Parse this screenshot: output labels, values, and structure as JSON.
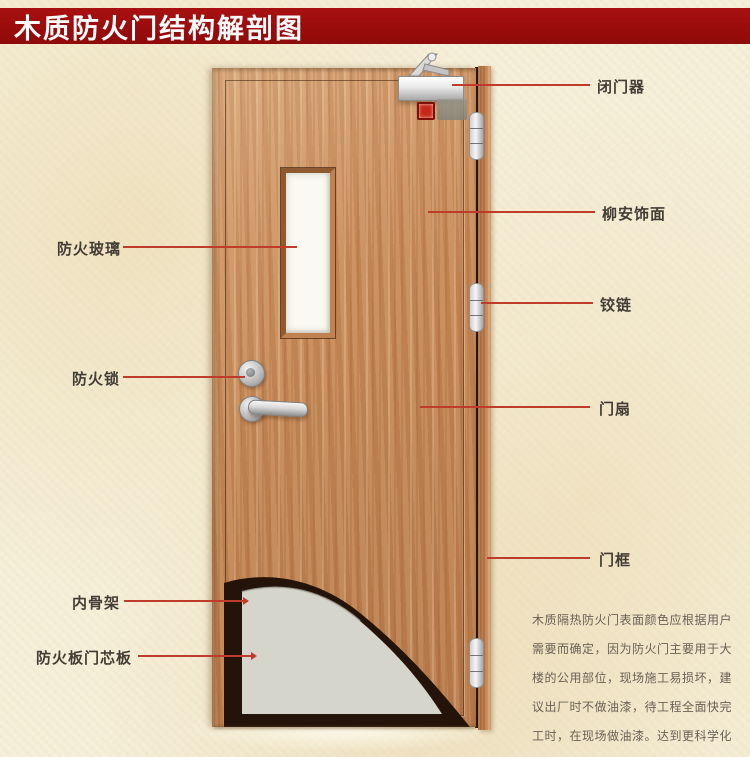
{
  "title": "木质防火门结构解剖图",
  "annotations": {
    "left": [
      {
        "id": "fire-glass",
        "text": "防火玻璃"
      },
      {
        "id": "fire-lock",
        "text": "防火锁"
      },
      {
        "id": "inner-skeleton",
        "text": "内骨架"
      },
      {
        "id": "core-board",
        "text": "防火板门芯板"
      }
    ],
    "right": [
      {
        "id": "door-closer",
        "text": "闭门器"
      },
      {
        "id": "lauan-veneer",
        "text": "柳安饰面"
      },
      {
        "id": "hinge",
        "text": "铰链"
      },
      {
        "id": "door-leaf",
        "text": "门扇"
      },
      {
        "id": "door-frame",
        "text": "门框"
      }
    ]
  },
  "description": {
    "lines": [
      "木质隔热防火门表面颜色应根据用户",
      "需要而确定，因为防火门主要用于大",
      "楼的公用部位，现场施工易损坏，建",
      "议出厂时不做油漆，待工程全面快完",
      "工时，在现场做油漆。达到更科学化",
      "更人性化的服务。"
    ]
  },
  "colors": {
    "banner_red": "#9c0c0c",
    "background_cream": "#f5eed8",
    "annotation_line_red": "#bf3b2a",
    "door_wood": "#c78a58",
    "glass_white": "#fbfaf2",
    "core_board_gray": "#d5d5cc",
    "inner_skeleton_dark": "#241309"
  }
}
